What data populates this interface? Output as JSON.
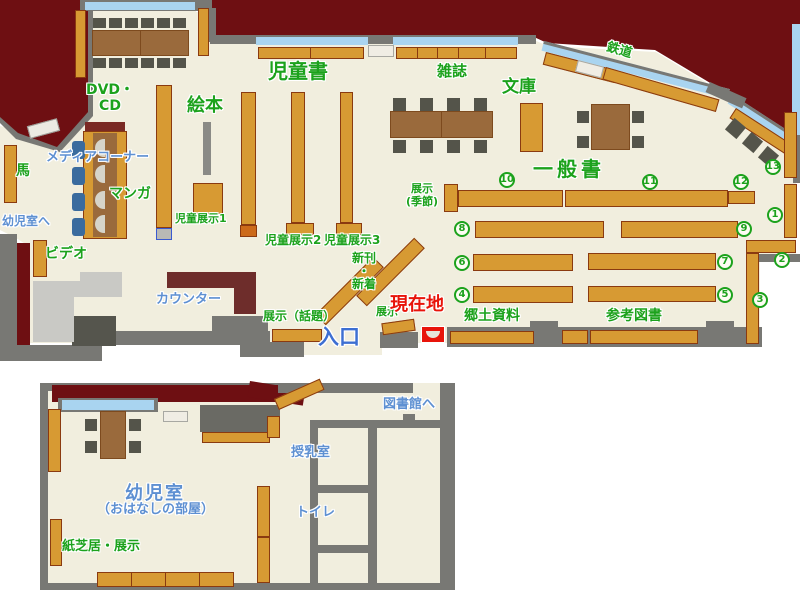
{
  "colors": {
    "floor": "#f1eede",
    "outside_dark_red": "#6e0f12",
    "wall_gray": "#787874",
    "shelf_fill": "#d79a33",
    "shelf_border": "#8a3a10",
    "table_brown": "#9a6a3c",
    "chair_dark_gray": "#54544a",
    "window_blue": "#a9d4f0",
    "counter_dark_red": "#6e2d2b",
    "label_green": "#1ca21c",
    "label_blue": "#5e90d2",
    "entrance_blue": "#3d6fd2",
    "current_location_red": "#e8140a"
  },
  "main_floor": {
    "sections": {
      "jidosho": "児童書",
      "ehon": "絵本",
      "zasshi": "雑誌",
      "bunko": "文庫",
      "ippansho": "一般書",
      "tetsudo": "鉄道",
      "dvd_cd": "DVD・\nCD",
      "manga": "マンガ",
      "uma": "馬",
      "video": "ビデオ",
      "kyodo_shiryo": "郷土資料",
      "sanko_tosho": "参考図書"
    },
    "facilities": {
      "media_corner": "メディアコーナー",
      "to_infant_room": "幼児室へ",
      "counter": "カウンター",
      "entrance": "入口"
    },
    "exhibits": {
      "jido_tenji1": "児童展示1",
      "jido_tenji2": "児童展示2",
      "jido_tenji3": "児童展示3",
      "tenji_kisetsu": "展示\n(季節)",
      "tenji_wadai": "展示（話題）",
      "tenji": "展示",
      "shinkan_shinchaku": "新刊\n・\n新着"
    },
    "current_location": "現在地",
    "shelf_numbers": [
      "1",
      "2",
      "3",
      "4",
      "5",
      "6",
      "7",
      "8",
      "9",
      "10",
      "11",
      "12",
      "13"
    ]
  },
  "annex": {
    "room": "幼児室",
    "room_note": "（おはなしの部屋）",
    "kamishibai_tenji": "紙芝居・展示",
    "nursing_room": "授乳室",
    "toilet": "トイレ",
    "to_library": "図書館へ"
  }
}
